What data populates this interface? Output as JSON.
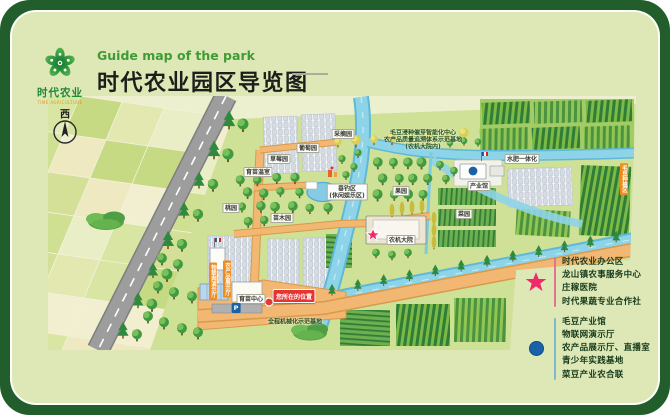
{
  "header": {
    "logo_cn": "时代农业",
    "logo_en": "TIME AGRICULTURE",
    "subtitle": "Guide map of the park",
    "title": "时代农业园区导览图"
  },
  "map": {
    "labels": [
      {
        "text": "西",
        "x": 63,
        "y": 111,
        "type": "compass"
      },
      {
        "text": "草莓园",
        "x": 277,
        "y": 157,
        "type": "box"
      },
      {
        "text": "葡萄园",
        "x": 306,
        "y": 146,
        "type": "box"
      },
      {
        "text": "育苗温室",
        "x": 256,
        "y": 170,
        "type": "box"
      },
      {
        "text": "桃园",
        "x": 229,
        "y": 206,
        "type": "box"
      },
      {
        "text": "苗木园",
        "x": 280,
        "y": 216,
        "type": "box"
      },
      {
        "text": "采摘园",
        "x": 341,
        "y": 132,
        "type": "box"
      },
      {
        "text": "果园",
        "x": 399,
        "y": 189,
        "type": "box"
      },
      {
        "text": "菜园",
        "x": 462,
        "y": 212,
        "type": "box"
      },
      {
        "lines": [
          "垂钓区",
          "(休闲娱乐区)"
        ],
        "x": 345,
        "y": 190,
        "type": "box2"
      },
      {
        "text": "产业馆",
        "x": 477,
        "y": 184,
        "type": "box"
      },
      {
        "text": "农机大院",
        "x": 399,
        "y": 238,
        "type": "box"
      },
      {
        "text": "水肥一体化",
        "x": 520,
        "y": 157,
        "type": "box"
      },
      {
        "text": "育苗中心",
        "x": 249,
        "y": 297,
        "type": "box"
      },
      {
        "text": "物联网演示厅",
        "x": 211,
        "y": 279,
        "type": "vorange"
      },
      {
        "text": "农产品展示厅",
        "x": 225,
        "y": 277,
        "type": "vorange"
      },
      {
        "text": "毛豆种植区",
        "x": 622,
        "y": 177,
        "type": "vorange"
      },
      {
        "text": "您所在的位置",
        "x": 292,
        "y": 294,
        "type": "red"
      },
      {
        "text": "全程机械化示范基地",
        "x": 293,
        "y": 319,
        "type": "dark"
      },
      {
        "text": "毛豆浸种催芽智能化中心",
        "x": 421,
        "y": 130,
        "type": "dark"
      },
      {
        "text": "农产品质量追溯体系示范基地",
        "x": 421,
        "y": 137,
        "type": "dark"
      },
      {
        "text": "(农机大院内)",
        "x": 421,
        "y": 144,
        "type": "dark"
      },
      {
        "text": "P",
        "x": 234,
        "y": 306,
        "type": "pbadge"
      }
    ]
  },
  "legend": {
    "star_color": "#ee2a6b",
    "star_items": [
      "时代农业办公区",
      "龙山镇农事服务中心",
      "庄稼医院",
      "时代果蔬专业合作社"
    ],
    "dot_color": "#1a62a8",
    "dot_items": [
      "毛豆产业馆",
      "物联网演示厅",
      "农产品展示厅、直播室",
      "青少年实践基地",
      "菜豆产业农合联"
    ]
  },
  "colors": {
    "frame": "#215e2c",
    "card": "#dde8b6",
    "title_green": "#3f9c35",
    "canal": "#8ed4e8",
    "road_orange": "#f2b873"
  }
}
